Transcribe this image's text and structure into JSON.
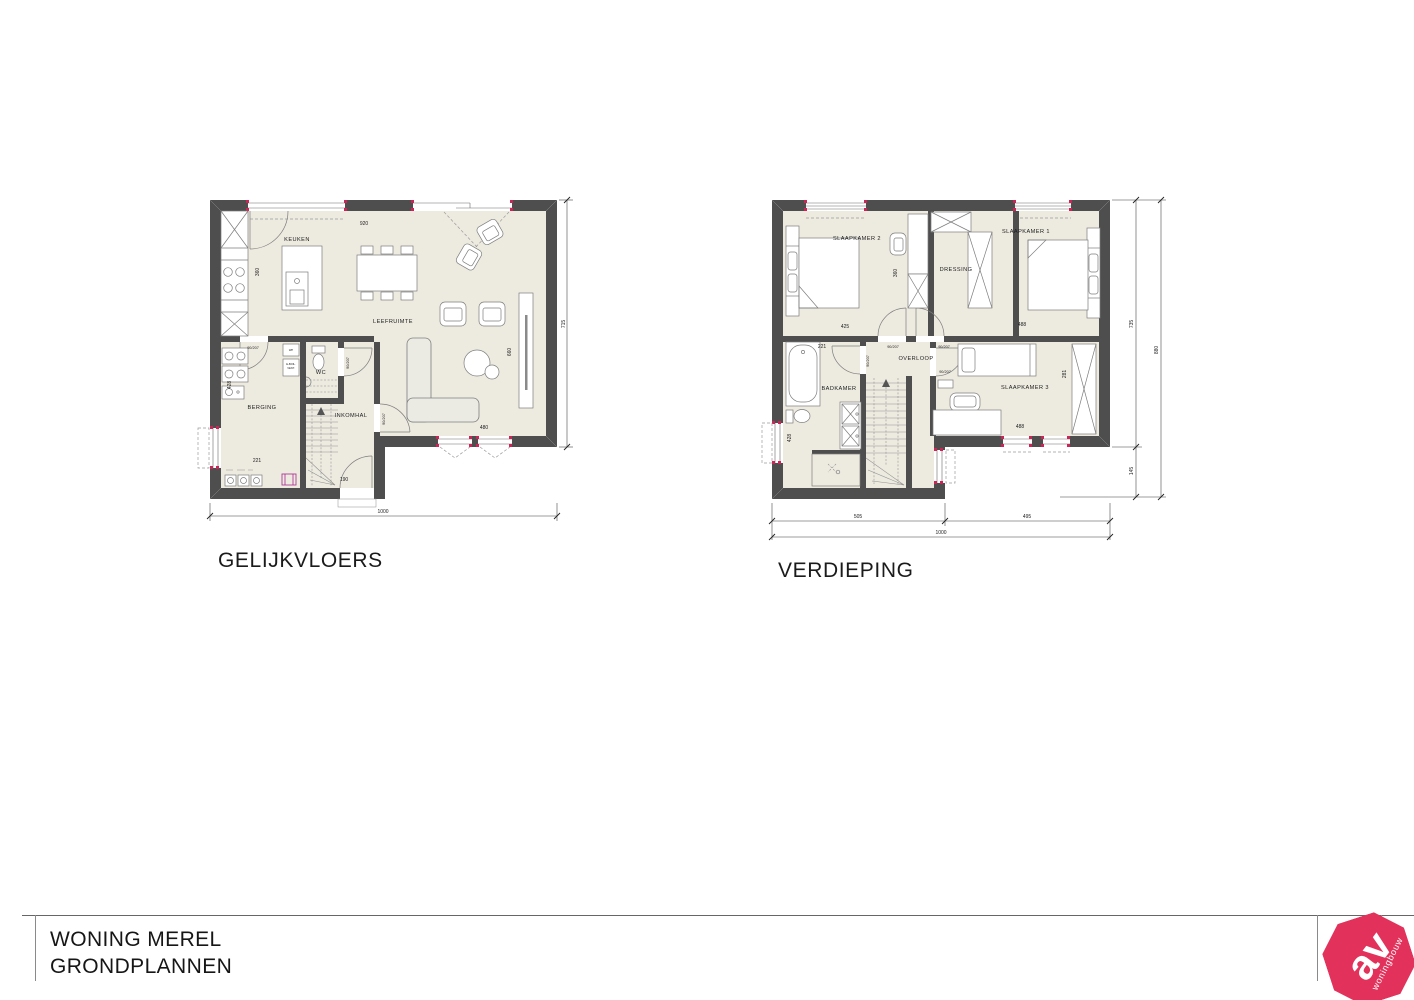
{
  "titles": {
    "ground_floor": "GELIJKVLOERS",
    "upper_floor": "VERDIEPING"
  },
  "title_block": {
    "project_name": "WONING MEREL",
    "drawing_name": "GRONDPLANNEN"
  },
  "logo": {
    "initials": "av",
    "tagline": "woningbouw",
    "brand_color": "#e2325b"
  },
  "colors": {
    "wall": "#4e4e4e",
    "floor": "#edebe0",
    "window_accent": "#cf2358"
  },
  "door_size_label": "90/207",
  "ground_floor": {
    "rooms": {
      "keuken": "KEUKEN",
      "leefruimte": "LEEFRUIMTE",
      "wc": "WC",
      "berging": "BERGING",
      "inkomhal": "INKOMHAL"
    },
    "appliances": {
      "wp": "WP",
      "boiler_line1": "E-BOIL.",
      "boiler_line2": "VENT."
    },
    "dims": {
      "kitchen_window": "920",
      "kitchen_depth": "360",
      "berging_depth": "428",
      "berging_width": "221",
      "front_door": "190",
      "rear_doors": "480",
      "living_width": "660",
      "right_total": "715",
      "bottom_total": "1000"
    }
  },
  "upper_floor": {
    "rooms": {
      "slaapkamer2": "SLAAPKAMER 2",
      "slaapkamer1": "SLAAPKAMER 1",
      "dressing": "DRESSING",
      "overloop": "OVERLOOP",
      "badkamer": "BADKAMER",
      "slaapkamer3": "SLAAPKAMER 3"
    },
    "dims": {
      "slk2_width": "425",
      "slk1_width": "488",
      "badkamer_top": "221",
      "dressing_depth": "360",
      "slk3_depth": "281",
      "slk3_width": "488",
      "badkamer_left": "428",
      "right_upper": "735",
      "right_lower": "145",
      "right_total": "880",
      "bottom_left": "505",
      "bottom_right": "495",
      "bottom_total": "1000"
    }
  }
}
